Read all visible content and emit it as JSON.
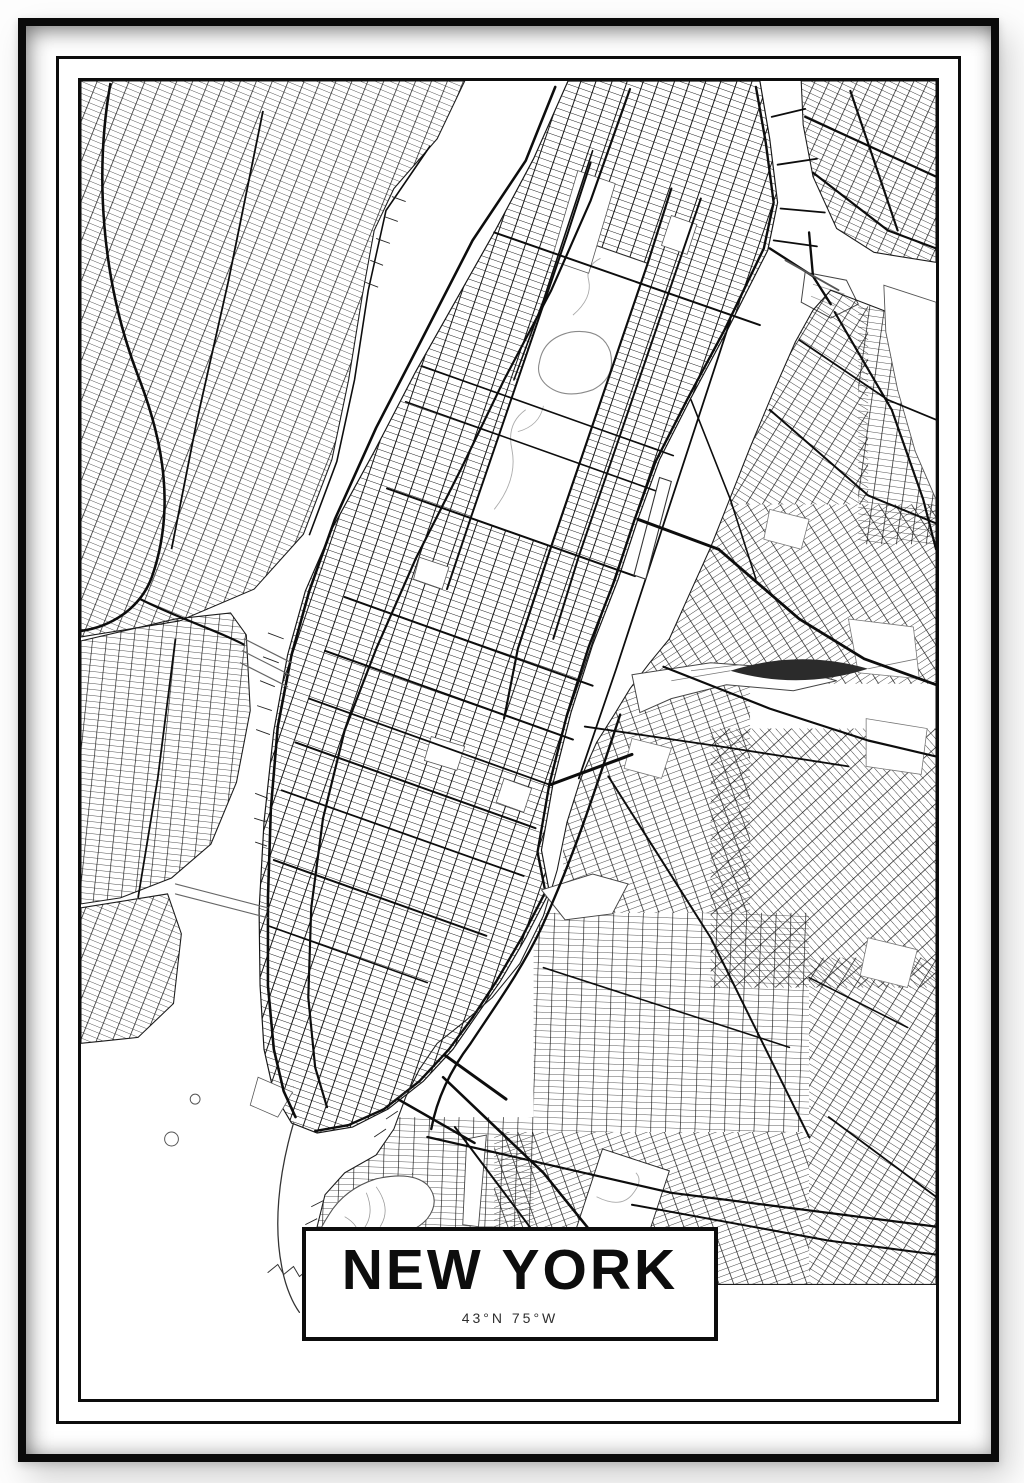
{
  "poster": {
    "kind": "framed city map poster",
    "title": "NEW YORK",
    "coordinates": "43°N 75°W",
    "map_subject": "New York City street network (Manhattan, New Jersey shore, Bronx, Queens, Brooklyn, Hudson River, East River, Upper Bay)",
    "colors": {
      "street_line": "#141414",
      "background": "#ffffff",
      "frame": "#0a0a0a",
      "muted_line": "#777777"
    }
  }
}
